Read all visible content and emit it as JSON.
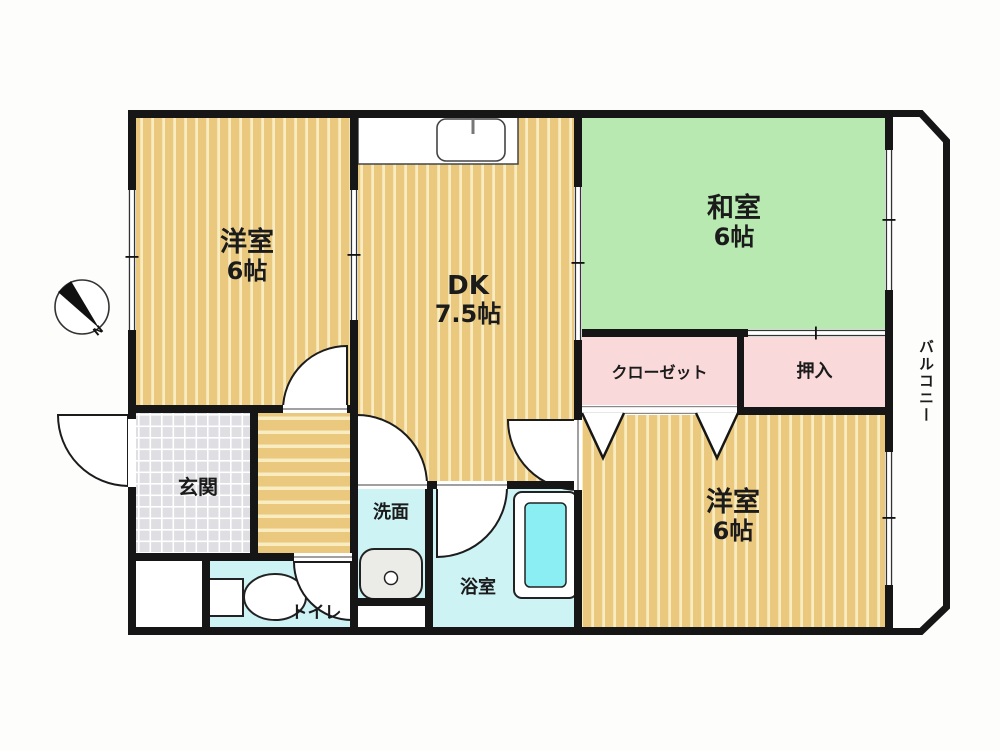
{
  "plan": {
    "rooms": {
      "western_room_top": {
        "name": "洋室",
        "size": "6帖"
      },
      "dining_kitchen": {
        "name": "DK",
        "size": "7.5帖"
      },
      "japanese_room": {
        "name": "和室",
        "size": "6帖"
      },
      "western_room_bottom": {
        "name": "洋室",
        "size": "6帖"
      },
      "closet": {
        "name": "クローゼット"
      },
      "oshiire": {
        "name": "押入"
      },
      "balcony": {
        "name": "バルコニー"
      },
      "entrance": {
        "name": "玄関"
      },
      "washroom": {
        "name": "洗面"
      },
      "bathroom": {
        "name": "浴室"
      },
      "toilet": {
        "name": "トイレ"
      }
    },
    "compass": {
      "north_label": "N"
    },
    "colors": {
      "wood_floor": "#eac87e",
      "wood_stripe": "#f8ecc0",
      "tatami_green": "#b7e9b0",
      "storage_pink": "#fad9da",
      "wet_area_cyan": "#cdf3f5",
      "bathtub_cyan": "#8aeef2",
      "tile_gray": "#dfdfe3",
      "wall_black": "#161616"
    }
  }
}
